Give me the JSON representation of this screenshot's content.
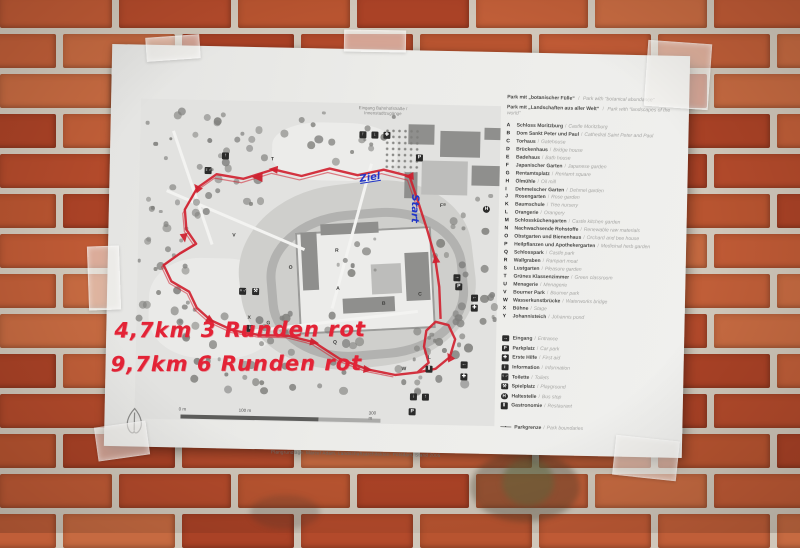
{
  "paper": {
    "top_note": {
      "line1": "Eingang Bahnhofstraße /",
      "line2": "Innenstadtzugänge"
    },
    "credit": "Plangrundlage: Marcel Adam, Landschaftsarchitekten, Potsdam, Stand 2005",
    "handwriting": {
      "line1": "4,7km  3 Runden rot",
      "line2": "9,7km  6 Runden rot"
    },
    "route_labels": {
      "ziel": "Ziel",
      "start": "Start"
    },
    "scalebar": {
      "labels": [
        "0 m",
        "100 m",
        "300 m"
      ]
    }
  },
  "legend": {
    "header": [
      {
        "de": "Park mit „botanischer Fülle“",
        "en": "Park with “botanical abundance”"
      },
      {
        "de": "Park mit „Landschaften aus aller Welt“",
        "en": "Park with “landscapes of the world”"
      }
    ],
    "items": [
      {
        "key": "A",
        "de": "Schloss Moritzburg",
        "en": "Castle Moritzburg"
      },
      {
        "key": "B",
        "de": "Dom Sankt Peter und Paul",
        "en": "Cathedral Saint Peter and Paul"
      },
      {
        "key": "C",
        "de": "Torhaus",
        "en": "Gatehouse"
      },
      {
        "key": "D",
        "de": "Brückenhaus",
        "en": "Bridge house"
      },
      {
        "key": "E",
        "de": "Badehaus",
        "en": "Bath house"
      },
      {
        "key": "F",
        "de": "Japanischer Garten",
        "en": "Japanese garden"
      },
      {
        "key": "G",
        "de": "Rentamtsplatz",
        "en": "Rentamt square"
      },
      {
        "key": "H",
        "de": "Ölmühle",
        "en": "Oil mill"
      },
      {
        "key": "I",
        "de": "Dehmelscher Garten",
        "en": "Dehmel garden"
      },
      {
        "key": "J",
        "de": "Rosengarten",
        "en": "Rose garden"
      },
      {
        "key": "K",
        "de": "Baumschule",
        "en": "Tree nursery"
      },
      {
        "key": "L",
        "de": "Orangerie",
        "en": "Orangery"
      },
      {
        "key": "M",
        "de": "Schlossküchengarten",
        "en": "Castle kitchen garden"
      },
      {
        "key": "N",
        "de": "Nachwachsende Rohstoffe",
        "en": "Renewable raw materials"
      },
      {
        "key": "O",
        "de": "Obstgarten und Bienenhaus",
        "en": "Orchard and bee house"
      },
      {
        "key": "P",
        "de": "Heilpflanzen und Apothekergarten",
        "en": "Medicinal herb garden"
      },
      {
        "key": "Q",
        "de": "Schlosspark",
        "en": "Castle park"
      },
      {
        "key": "R",
        "de": "Wallgraben",
        "en": "Rampart moat"
      },
      {
        "key": "S",
        "de": "Lustgarten",
        "en": "Pleasure garden"
      },
      {
        "key": "T",
        "de": "Grünes Klassenzimmer",
        "en": "Green classroom"
      },
      {
        "key": "U",
        "de": "Menagerie",
        "en": "Menagerie"
      },
      {
        "key": "V",
        "de": "Bourner Park",
        "en": "Bourner park"
      },
      {
        "key": "W",
        "de": "Wasserkunstbrücke",
        "en": "Waterworks bridge"
      },
      {
        "key": "X",
        "de": "Bühne",
        "en": "Stage"
      },
      {
        "key": "Y",
        "de": "Johannisteich",
        "en": "Johannis pond"
      }
    ],
    "symbols": [
      {
        "icon": "entrance-arrow-icon",
        "glyph": "arrow-right",
        "de": "Eingang",
        "en": "Entrance"
      },
      {
        "icon": "parking-icon",
        "glyph": "parking",
        "de": "Parkplatz",
        "en": "Car park"
      },
      {
        "icon": "first-aid-icon",
        "glyph": "first-aid",
        "de": "Erste Hilfe",
        "en": "First aid"
      },
      {
        "icon": "information-icon",
        "glyph": "information",
        "de": "Information",
        "en": "Information"
      },
      {
        "icon": "toilets-icon",
        "glyph": "toilets",
        "de": "Toilette",
        "en": "Toilets"
      },
      {
        "icon": "playground-icon",
        "glyph": "playground",
        "de": "Spielplatz",
        "en": "Playground"
      },
      {
        "icon": "bus-stop-icon",
        "glyph": "bus-stop",
        "de": "Haltestelle",
        "en": "Bus stop"
      },
      {
        "icon": "restaurant-icon",
        "glyph": "restaurant",
        "de": "Gastronomie",
        "en": "Restaurant"
      },
      {
        "icon": "park-boundary-icon",
        "glyph": "boundary",
        "de": "Parkgrenze",
        "en": "Park boundaries"
      }
    ]
  },
  "map_markers": [
    {
      "label": "T",
      "x": 149,
      "y": 88
    },
    {
      "label": "V",
      "x": 112,
      "y": 165
    },
    {
      "label": "O",
      "x": 169,
      "y": 196
    },
    {
      "label": "R",
      "x": 215,
      "y": 178
    },
    {
      "label": "A",
      "x": 217,
      "y": 216
    },
    {
      "label": "B",
      "x": 263,
      "y": 230
    },
    {
      "label": "C",
      "x": 299,
      "y": 220
    },
    {
      "label": "Q",
      "x": 215,
      "y": 270
    },
    {
      "label": "P",
      "x": 242,
      "y": 254
    },
    {
      "label": "X",
      "x": 129,
      "y": 247
    },
    {
      "label": "G",
      "x": 148,
      "y": 252
    },
    {
      "label": "F",
      "x": 319,
      "y": 131
    },
    {
      "label": "L",
      "x": 310,
      "y": 283
    },
    {
      "label": "W",
      "x": 284,
      "y": 295
    }
  ],
  "map_icons": [
    {
      "glyph": "arrow-up",
      "x": 100,
      "y": 84
    },
    {
      "glyph": "toilets",
      "x": 83,
      "y": 99
    },
    {
      "glyph": "parking",
      "x": 294,
      "y": 82
    },
    {
      "glyph": "parking",
      "x": 336,
      "y": 210
    },
    {
      "glyph": "bus-stop",
      "x": 362,
      "y": 132
    },
    {
      "glyph": "information",
      "x": 128,
      "y": 256
    },
    {
      "glyph": "arrow-right",
      "x": 334,
      "y": 201
    },
    {
      "glyph": "arrow-left",
      "x": 352,
      "y": 221
    },
    {
      "glyph": "first-aid",
      "x": 352,
      "y": 231
    },
    {
      "glyph": "arrow-left",
      "x": 343,
      "y": 288
    },
    {
      "glyph": "first-aid",
      "x": 343,
      "y": 300
    },
    {
      "glyph": "arrow-down",
      "x": 293,
      "y": 321
    },
    {
      "glyph": "arrow-up",
      "x": 305,
      "y": 321
    },
    {
      "glyph": "parking",
      "x": 292,
      "y": 336
    },
    {
      "glyph": "toilets",
      "x": 120,
      "y": 219
    },
    {
      "glyph": "playground",
      "x": 133,
      "y": 219
    },
    {
      "glyph": "arrow-up",
      "x": 237,
      "y": 60
    },
    {
      "glyph": "arrow-down",
      "x": 249,
      "y": 60
    },
    {
      "glyph": "first-aid",
      "x": 261,
      "y": 60
    },
    {
      "glyph": "restaurant",
      "x": 308,
      "y": 293
    }
  ],
  "colors": {
    "route_red": "#d01f2e",
    "marker_red": "#e32336",
    "handwriting_blue": "#2136c8",
    "brick": "#bb4f2e",
    "mortar": "#d0c7ba",
    "paper": "#ecece9"
  }
}
